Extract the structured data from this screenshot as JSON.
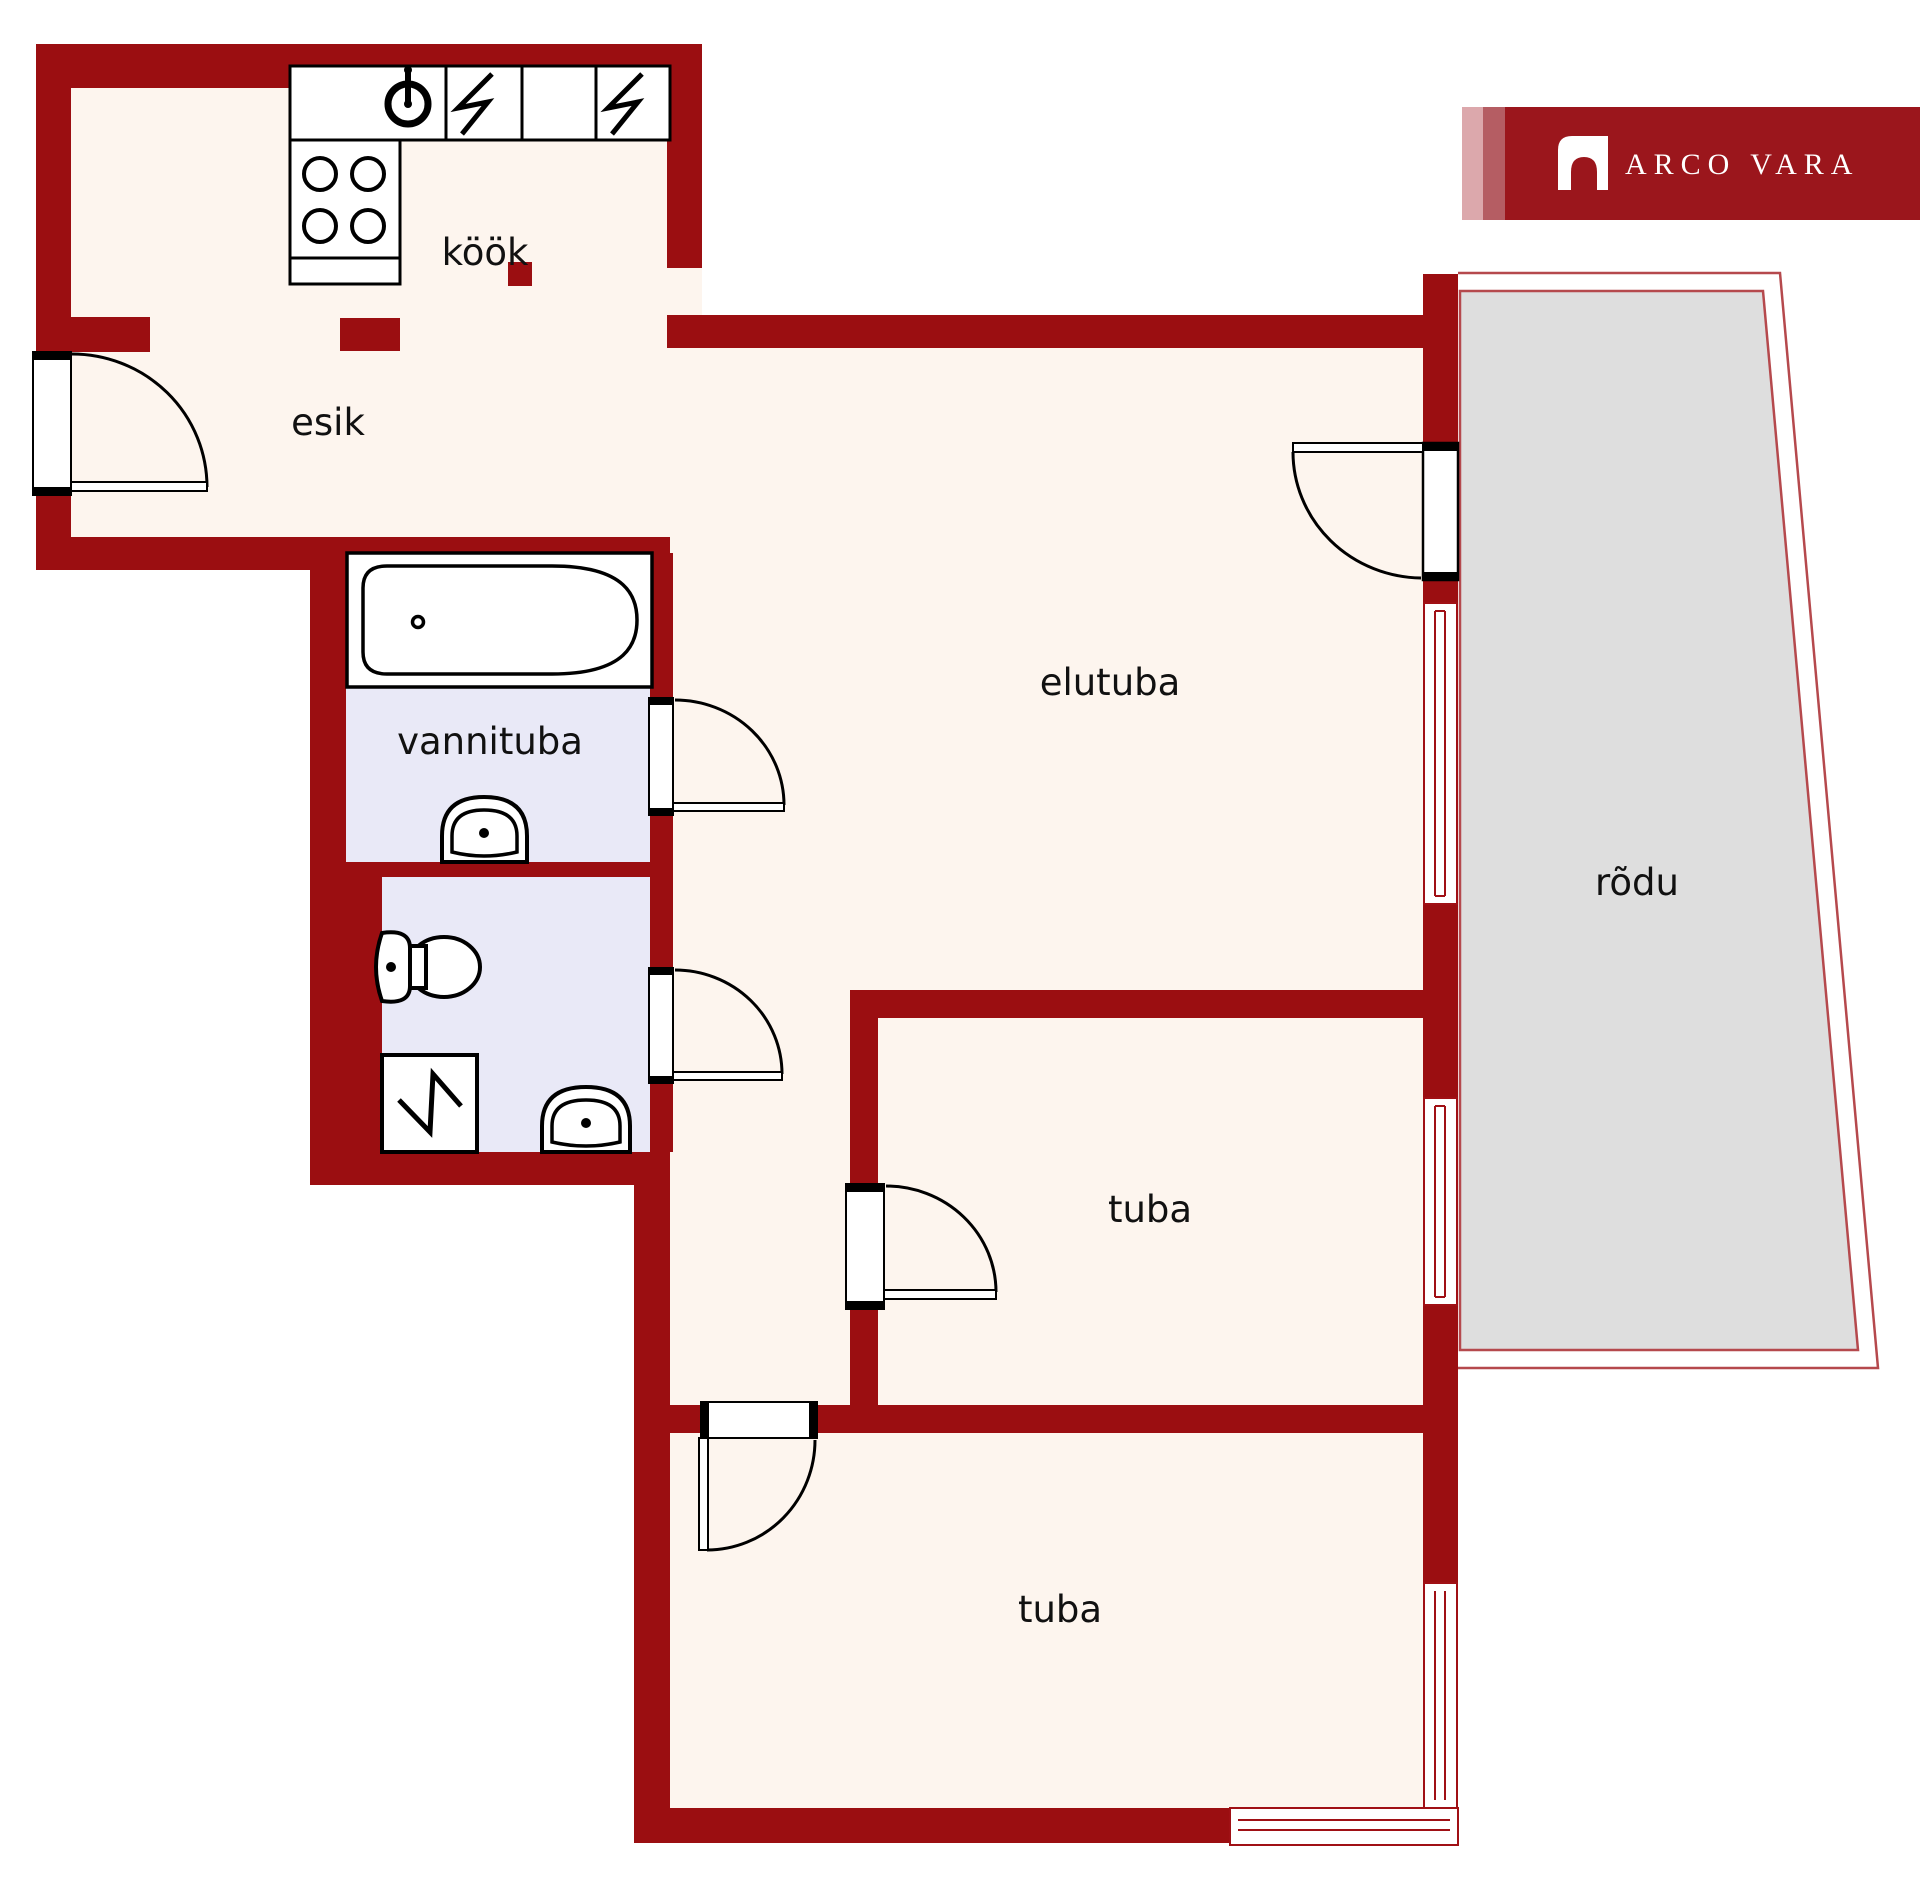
{
  "title": "Apartment floor plan",
  "brand": {
    "logo_text": "ARCO VARA",
    "logo_mark": "arch-icon",
    "banner_color": "#9b161c",
    "stripe_light": "#dca8ac",
    "stripe_medium": "#b55d63"
  },
  "palette": {
    "wall": "#9b0e11",
    "floor": "#fdf5ee",
    "bathroom_floor": "#e9e9f7",
    "balcony_fill": "#dedede",
    "balcony_outline": "#b5494d",
    "fixture_stroke": "#000000",
    "label_color": "#111111",
    "background": "#ffffff"
  },
  "rooms": [
    {
      "id": "kook",
      "label": "köök"
    },
    {
      "id": "esik",
      "label": "esik"
    },
    {
      "id": "vannituba",
      "label": "vannituba"
    },
    {
      "id": "elutuba",
      "label": "elutuba"
    },
    {
      "id": "tuba-middle",
      "label": "tuba"
    },
    {
      "id": "tuba-bottom",
      "label": "tuba"
    },
    {
      "id": "rodu",
      "label": "rõdu"
    }
  ],
  "fixtures": [
    "bathtub",
    "bathroom-sink",
    "toilet",
    "washing-machine",
    "stove-burners",
    "kitchen-sink-dial",
    "electric-appliance-lightning",
    "door-swing-arc",
    "window",
    "balcony"
  ]
}
